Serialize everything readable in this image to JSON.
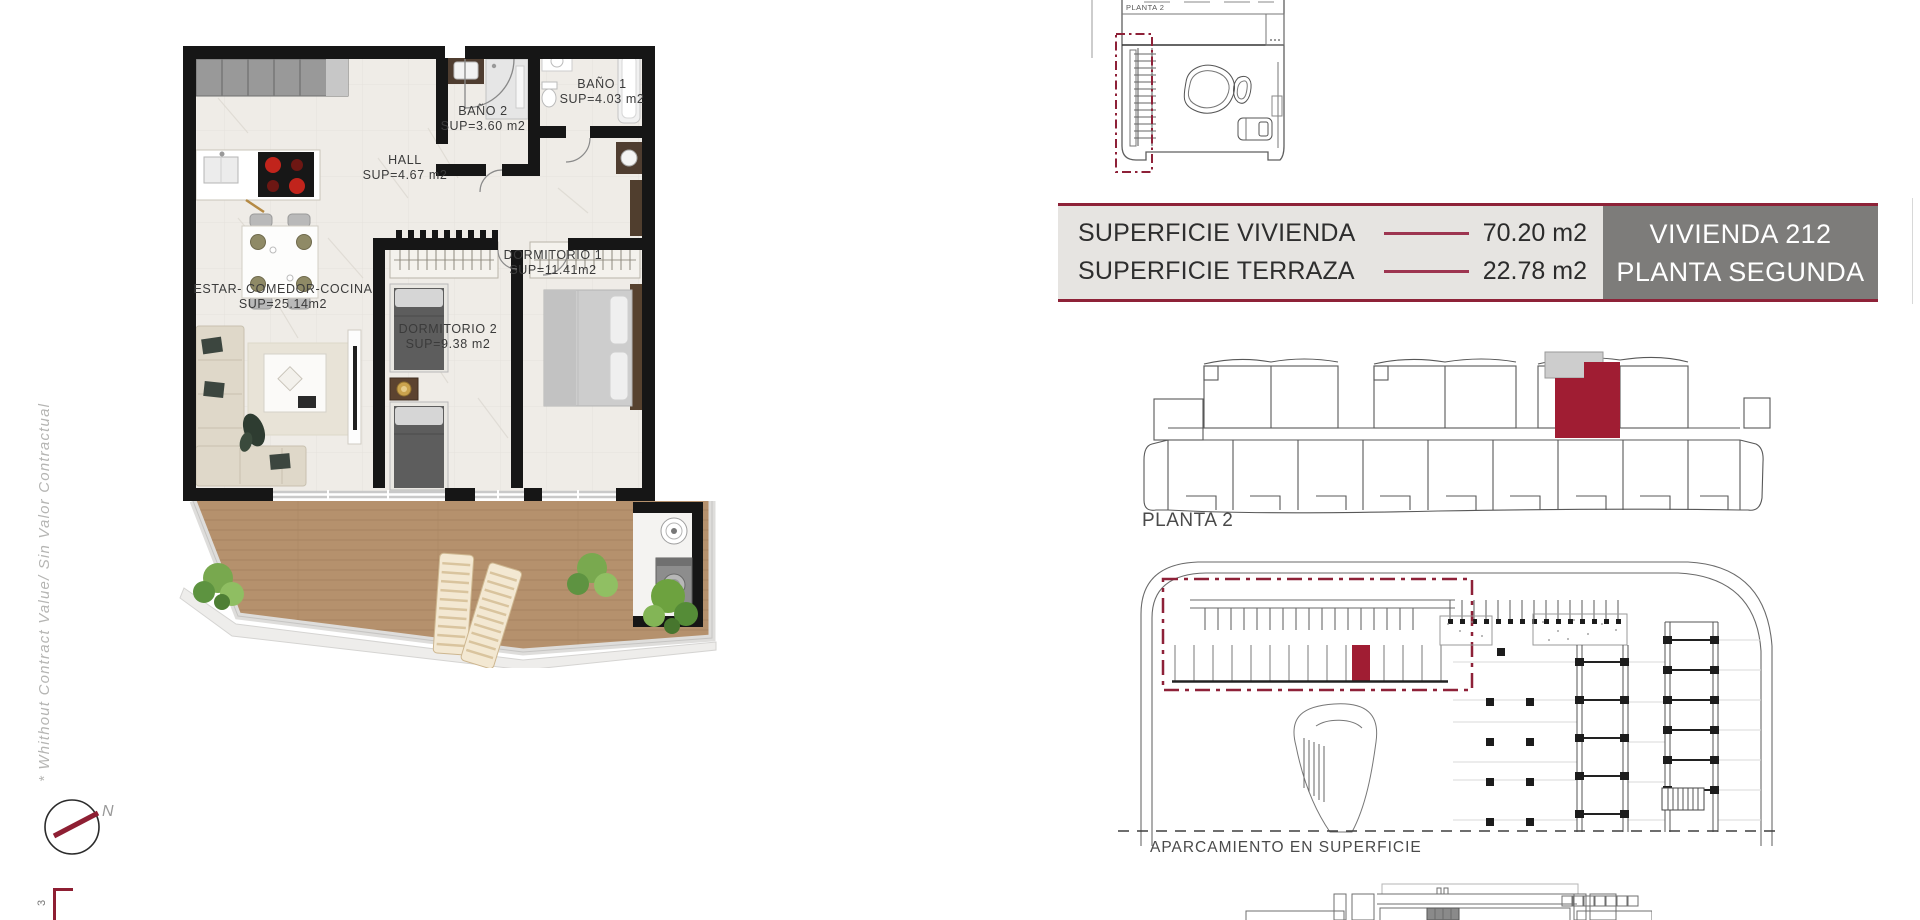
{
  "disclaimer": {
    "text": "* Whithout Contract Value/ Sin Valor Contractual"
  },
  "compass": {
    "north_label": "N"
  },
  "scale_figure": {
    "number": "3"
  },
  "floor_plan": {
    "rooms": [
      {
        "id": "estar",
        "name": "ESTAR- COMEDOR-COCINA",
        "area": "SUP=25.14m2"
      },
      {
        "id": "hall",
        "name": "HALL",
        "area": "SUP=4.67 m2"
      },
      {
        "id": "bano2",
        "name": "BAÑO 2",
        "area": "SUP=3.60 m2"
      },
      {
        "id": "bano1",
        "name": "BAÑO 1",
        "area": "SUP=4.03 m2"
      },
      {
        "id": "dorm2",
        "name": "DORMITORIO 2",
        "area": "SUP=9.38 m2"
      },
      {
        "id": "dorm1",
        "name": "DORMITORIO 1",
        "area": "SUP=11.41m2"
      }
    ]
  },
  "summary_banner": {
    "rows": [
      {
        "label": "SUPERFICIE VIVIENDA",
        "value": "70.20 m2"
      },
      {
        "label": "SUPERFICIE TERRAZA",
        "value": "22.78 m2"
      }
    ],
    "unit_name": "VIVIENDA 212",
    "unit_floor": "PLANTA SEGUNDA"
  },
  "key_plans": {
    "roof_plan_label": "PLANTA 2",
    "floor_key_label": "PLANTA 2",
    "parking_label": "APARCAMIENTO EN SUPERFICIE"
  },
  "colors": {
    "accent_maroon": "#8e2238",
    "highlight_crimson": "#a01d33",
    "dash_line": "#9d3550",
    "panel_gray": "#7d7c7a",
    "panel_light": "#e6e4e1",
    "wall_black": "#161616",
    "deck_wood": "#b5916d",
    "marble_floor": "#efece7"
  }
}
